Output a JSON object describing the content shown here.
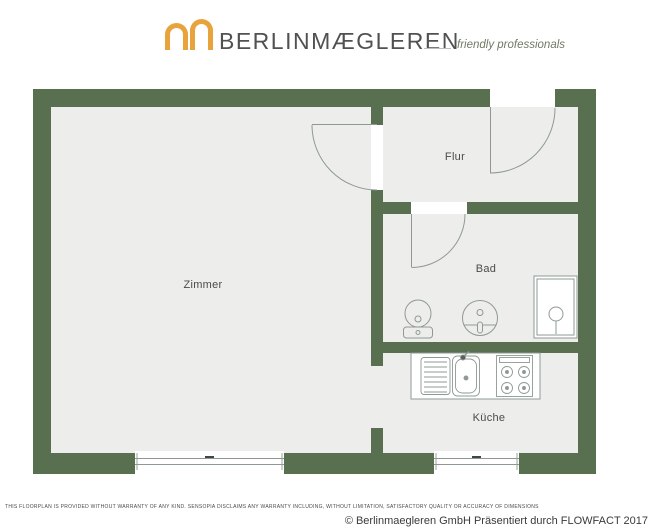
{
  "header": {
    "brand": "BERLINMÆGLEREN",
    "tagline": "friendly professionals"
  },
  "plan": {
    "rooms": {
      "zimmer": {
        "label": "Zimmer"
      },
      "flur": {
        "label": "Flur"
      },
      "bad": {
        "label": "Bad"
      },
      "kueche": {
        "label": "Küche"
      }
    },
    "fixtures": [
      "toilet-icon",
      "washbasin-icon",
      "shower-icon",
      "kitchen-sink-icon",
      "stove-icon"
    ],
    "doors": [
      "entry-door",
      "zimmer-door",
      "bad-door",
      "kueche-opening"
    ],
    "windows": [
      "zimmer-window",
      "kueche-window"
    ]
  },
  "icons": {
    "logo": "double-arch-icon"
  },
  "colors": {
    "wall_green": "#586F50",
    "floor_gray": "#EDEEEC",
    "logo_orange": "#E8A33C",
    "plan_line": "#8E9994"
  },
  "footer": {
    "disclaimer": "THIS FLOORPLAN IS PROVIDED WITHOUT WARRANTY OF ANY KIND. SENSOPIA DISCLAIMS ANY WARRANTY INCLUDING, WITHOUT LIMITATION, SATISFACTORY QUALITY OR ACCURACY OF DIMENSIONS",
    "copyright": "© Berlinmaegleren GmbH Präsentiert durch FLOWFACT 2017"
  }
}
